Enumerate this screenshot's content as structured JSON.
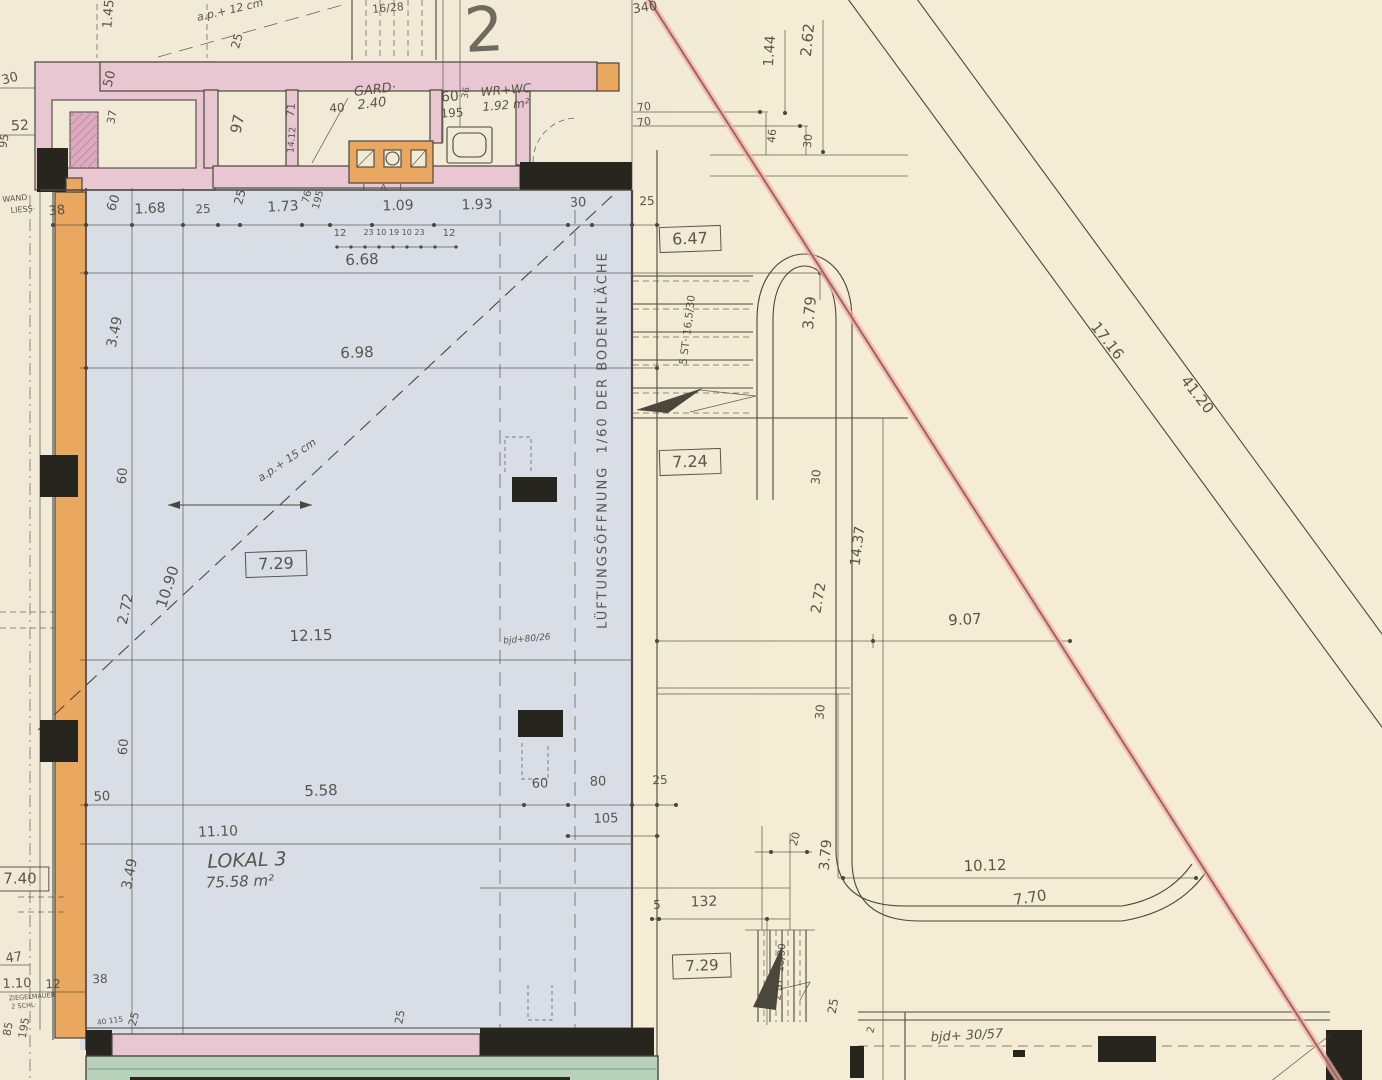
{
  "title": "Hand-drawn architectural floor plan, Lokal 3 (75.58 m2)",
  "colors": {
    "paper": "#f1ead6",
    "paper_right": "#f4ecd4",
    "plan_blue": "#d9dde6",
    "wall_pink": "#e8c6d2",
    "wall_pink_dark": "#dcaabf",
    "wall_orange": "#e9a75f",
    "wall_black": "#26251e",
    "sidewalk_green": "#b7d1ba",
    "boundary_red": "#d98079",
    "boundary_red_halo": "#f0b4ad",
    "ink": "#4a473c"
  },
  "rooms": {
    "main": {
      "name": "LOKAL 3",
      "area": "75.58 m²"
    },
    "wardrobe": {
      "name": "GARD·",
      "area": "2.40"
    },
    "wc": {
      "name": "WR+WC",
      "area": "1.92 m²"
    }
  },
  "notes": {
    "ventilation": "LÜFTUNGSÖFFNUNG  1/60 DER BODENFLÄCHE",
    "stairs_upper": "5 ST· 16,5/30",
    "stairs_lower": "2 ST· 16/30",
    "beam_1": "bjd+80/26",
    "beam_2": "bjd+ 30/57",
    "parapet_1": "a.p.+ 12 cm",
    "parapet_2": "a.p.+ 15 cm",
    "riser_note": "16/28"
  },
  "labels": [
    {
      "t": "30",
      "x": 10,
      "y": 79,
      "r": -15,
      "s": 13
    },
    {
      "t": "52",
      "x": 20,
      "y": 126,
      "r": -3,
      "s": 14
    },
    {
      "t": "95",
      "x": 4,
      "y": 141,
      "r": -80,
      "s": 11
    },
    {
      "t": "WAND",
      "x": 15,
      "y": 199,
      "r": -5,
      "s": 8
    },
    {
      "t": "LIESS·",
      "x": 23,
      "y": 210,
      "r": -5,
      "s": 8
    },
    {
      "t": "1.45",
      "x": 109,
      "y": 14,
      "r": -85,
      "s": 13
    },
    {
      "t": "50",
      "x": 110,
      "y": 79,
      "r": -75,
      "s": 13
    },
    {
      "t": "37",
      "x": 112,
      "y": 117,
      "r": -80,
      "s": 11
    },
    {
      "t": "a.p.+ 12 cm",
      "x": 230,
      "y": 10,
      "r": -13,
      "s": 11,
      "i": 1
    },
    {
      "t": "25",
      "x": 237,
      "y": 41,
      "r": -75,
      "s": 12
    },
    {
      "t": "97",
      "x": 238,
      "y": 124,
      "r": -78,
      "s": 15
    },
    {
      "t": "71",
      "x": 291,
      "y": 110,
      "r": -85,
      "s": 11
    },
    {
      "t": "14.12",
      "x": 293,
      "y": 140,
      "r": -85,
      "s": 9
    },
    {
      "t": "16/28",
      "x": 388,
      "y": 8,
      "r": -5,
      "s": 11
    },
    {
      "t": "2",
      "x": 484,
      "y": 30,
      "r": -3,
      "s": 62,
      "big": 1
    },
    {
      "t": "340",
      "x": 645,
      "y": 8,
      "r": -8,
      "s": 13
    },
    {
      "t": "GARD·",
      "x": 375,
      "y": 90,
      "r": -7,
      "s": 13,
      "i": 1
    },
    {
      "t": "2.40",
      "x": 372,
      "y": 104,
      "r": -7,
      "s": 13,
      "i": 1
    },
    {
      "t": "40",
      "x": 337,
      "y": 108,
      "r": -4,
      "s": 12
    },
    {
      "t": "60",
      "x": 450,
      "y": 97,
      "r": -4,
      "s": 14
    },
    {
      "t": "36",
      "x": 467,
      "y": 93,
      "r": -80,
      "s": 9
    },
    {
      "t": "195",
      "x": 452,
      "y": 113,
      "r": -3,
      "s": 12
    },
    {
      "t": "WR+WC",
      "x": 506,
      "y": 90,
      "r": -5,
      "s": 12,
      "i": 1
    },
    {
      "t": "1.92 m²",
      "x": 506,
      "y": 105,
      "r": -5,
      "s": 12,
      "i": 1
    },
    {
      "t": "L A L",
      "x": 386,
      "y": 189,
      "r": 0,
      "s": 9,
      "ls": 5
    },
    {
      "t": "1.44",
      "x": 770,
      "y": 51,
      "r": -86,
      "s": 14
    },
    {
      "t": "2.62",
      "x": 808,
      "y": 40,
      "r": -84,
      "s": 15
    },
    {
      "t": "70",
      "x": 644,
      "y": 107,
      "r": -8,
      "s": 11
    },
    {
      "t": "70",
      "x": 644,
      "y": 122,
      "r": -8,
      "s": 11
    },
    {
      "t": "46",
      "x": 772,
      "y": 136,
      "r": -85,
      "s": 11
    },
    {
      "t": "30",
      "x": 808,
      "y": 141,
      "r": -85,
      "s": 11
    },
    {
      "t": "38",
      "x": 57,
      "y": 211,
      "r": -5,
      "s": 13
    },
    {
      "t": "60",
      "x": 114,
      "y": 203,
      "r": -70,
      "s": 13
    },
    {
      "t": "1.68",
      "x": 150,
      "y": 209,
      "r": -3,
      "s": 14
    },
    {
      "t": "25",
      "x": 203,
      "y": 209,
      "r": -3,
      "s": 12
    },
    {
      "t": "25",
      "x": 240,
      "y": 197,
      "r": -75,
      "s": 12
    },
    {
      "t": "1.73",
      "x": 283,
      "y": 207,
      "r": -3,
      "s": 14
    },
    {
      "t": "76",
      "x": 308,
      "y": 197,
      "r": -75,
      "s": 10
    },
    {
      "t": "195",
      "x": 319,
      "y": 200,
      "r": -75,
      "s": 10
    },
    {
      "t": "1.09",
      "x": 398,
      "y": 206,
      "r": -2,
      "s": 14
    },
    {
      "t": "1.93",
      "x": 477,
      "y": 205,
      "r": -2,
      "s": 14
    },
    {
      "t": "30",
      "x": 578,
      "y": 203,
      "r": -2,
      "s": 13
    },
    {
      "t": "25",
      "x": 647,
      "y": 201,
      "r": -2,
      "s": 12
    },
    {
      "t": "12",
      "x": 340,
      "y": 234,
      "r": 0,
      "s": 10
    },
    {
      "t": "23 10 19 10 23",
      "x": 394,
      "y": 233,
      "r": 0,
      "s": 8
    },
    {
      "t": "12",
      "x": 449,
      "y": 234,
      "r": 0,
      "s": 10
    },
    {
      "t": "6.68",
      "x": 362,
      "y": 260,
      "r": -2,
      "s": 15
    },
    {
      "t": "6.98",
      "x": 357,
      "y": 353,
      "r": -2,
      "s": 15
    },
    {
      "t": "3.49",
      "x": 115,
      "y": 332,
      "r": -78,
      "s": 14
    },
    {
      "t": "60",
      "x": 123,
      "y": 476,
      "r": -85,
      "s": 13
    },
    {
      "t": "2.72",
      "x": 126,
      "y": 609,
      "r": -78,
      "s": 14
    },
    {
      "t": "10.90",
      "x": 168,
      "y": 587,
      "r": -72,
      "s": 15
    },
    {
      "t": "60",
      "x": 124,
      "y": 747,
      "r": -85,
      "s": 13
    },
    {
      "t": "50",
      "x": 102,
      "y": 797,
      "r": -3,
      "s": 13
    },
    {
      "t": "3.49",
      "x": 130,
      "y": 874,
      "r": -78,
      "s": 14
    },
    {
      "t": "a.p.+ 15 cm",
      "x": 287,
      "y": 460,
      "r": -34,
      "s": 11,
      "i": 1
    },
    {
      "t": "7.29",
      "x": 276,
      "y": 564,
      "r": -2,
      "s": 16,
      "b": 1
    },
    {
      "t": "12.15",
      "x": 311,
      "y": 636,
      "r": -2,
      "s": 15
    },
    {
      "t": "bjd+80/26",
      "x": 527,
      "y": 640,
      "r": -5,
      "s": 9,
      "i": 1
    },
    {
      "t": "LÜFTUNGSÖFFNUNG  1/60 DER BODENFLÄCHE",
      "x": 603,
      "y": 440,
      "r": -90,
      "s": 13,
      "ls": 2
    },
    {
      "t": "5.58",
      "x": 321,
      "y": 791,
      "r": -2,
      "s": 15
    },
    {
      "t": "60",
      "x": 540,
      "y": 784,
      "r": -2,
      "s": 13
    },
    {
      "t": "80",
      "x": 598,
      "y": 782,
      "r": -2,
      "s": 13
    },
    {
      "t": "25",
      "x": 660,
      "y": 780,
      "r": -2,
      "s": 12
    },
    {
      "t": "105",
      "x": 606,
      "y": 819,
      "r": -2,
      "s": 13
    },
    {
      "t": "11.10",
      "x": 218,
      "y": 832,
      "r": -2,
      "s": 14
    },
    {
      "t": "LOKAL 3",
      "x": 247,
      "y": 861,
      "r": -2,
      "s": 19,
      "i": 1
    },
    {
      "t": "75.58 m²",
      "x": 240,
      "y": 882,
      "r": -2,
      "s": 15,
      "i": 1
    },
    {
      "t": "7.40",
      "x": 20,
      "y": 879,
      "r": 0,
      "s": 15,
      "b": 1
    },
    {
      "t": "47",
      "x": 14,
      "y": 958,
      "r": -8,
      "s": 13
    },
    {
      "t": "1.10",
      "x": 17,
      "y": 984,
      "r": -2,
      "s": 13
    },
    {
      "t": "12",
      "x": 53,
      "y": 984,
      "r": -2,
      "s": 12
    },
    {
      "t": "38",
      "x": 100,
      "y": 979,
      "r": -2,
      "s": 12
    },
    {
      "t": "ZIEGELMAUER",
      "x": 32,
      "y": 997,
      "r": -4,
      "s": 6.5
    },
    {
      "t": "2 SCHL·",
      "x": 24,
      "y": 1006,
      "r": -4,
      "s": 6.5
    },
    {
      "t": "85",
      "x": 8,
      "y": 1029,
      "r": -80,
      "s": 11
    },
    {
      "t": "195",
      "x": 24,
      "y": 1028,
      "r": -80,
      "s": 11
    },
    {
      "t": "40 115",
      "x": 110,
      "y": 1021,
      "r": -8,
      "s": 7.5
    },
    {
      "t": "25",
      "x": 134,
      "y": 1019,
      "r": -75,
      "s": 11
    },
    {
      "t": "25",
      "x": 400,
      "y": 1017,
      "r": -80,
      "s": 11
    },
    {
      "t": "6.47",
      "x": 690,
      "y": 239,
      "r": -2,
      "s": 16,
      "b": 1
    },
    {
      "t": "5 ST· 16,5/30",
      "x": 688,
      "y": 330,
      "r": -83,
      "s": 10.5
    },
    {
      "t": "3.79",
      "x": 810,
      "y": 313,
      "r": -85,
      "s": 15
    },
    {
      "t": "7.24",
      "x": 690,
      "y": 462,
      "r": -2,
      "s": 16,
      "b": 1
    },
    {
      "t": "30",
      "x": 816,
      "y": 477,
      "r": -85,
      "s": 12
    },
    {
      "t": "2.72",
      "x": 819,
      "y": 598,
      "r": -80,
      "s": 14
    },
    {
      "t": "14.37",
      "x": 858,
      "y": 546,
      "r": -83,
      "s": 14
    },
    {
      "t": "9.07",
      "x": 965,
      "y": 620,
      "r": -3,
      "s": 15
    },
    {
      "t": "17.16",
      "x": 1107,
      "y": 341,
      "r": 52,
      "s": 15
    },
    {
      "t": "41.20",
      "x": 1197,
      "y": 395,
      "r": 52,
      "s": 15
    },
    {
      "t": "30",
      "x": 820,
      "y": 712,
      "r": -85,
      "s": 12
    },
    {
      "t": "20",
      "x": 795,
      "y": 839,
      "r": -75,
      "s": 11
    },
    {
      "t": "3.79",
      "x": 826,
      "y": 855,
      "r": -85,
      "s": 14
    },
    {
      "t": "10.12",
      "x": 985,
      "y": 866,
      "r": -2,
      "s": 15
    },
    {
      "t": "7.70",
      "x": 1030,
      "y": 898,
      "r": -9,
      "s": 15
    },
    {
      "t": "5",
      "x": 657,
      "y": 905,
      "r": 0,
      "s": 12
    },
    {
      "t": "132",
      "x": 704,
      "y": 902,
      "r": -2,
      "s": 14
    },
    {
      "t": "7.29",
      "x": 702,
      "y": 966,
      "r": -2,
      "s": 15,
      "b": 1
    },
    {
      "t": "2 ST· 16/30",
      "x": 781,
      "y": 972,
      "r": -85,
      "s": 10
    },
    {
      "t": "25",
      "x": 833,
      "y": 1006,
      "r": -80,
      "s": 12
    },
    {
      "t": "2",
      "x": 872,
      "y": 1030,
      "r": -75,
      "s": 10
    },
    {
      "t": "bjd+ 30/57",
      "x": 967,
      "y": 1036,
      "r": -3,
      "s": 13,
      "i": 1
    }
  ]
}
